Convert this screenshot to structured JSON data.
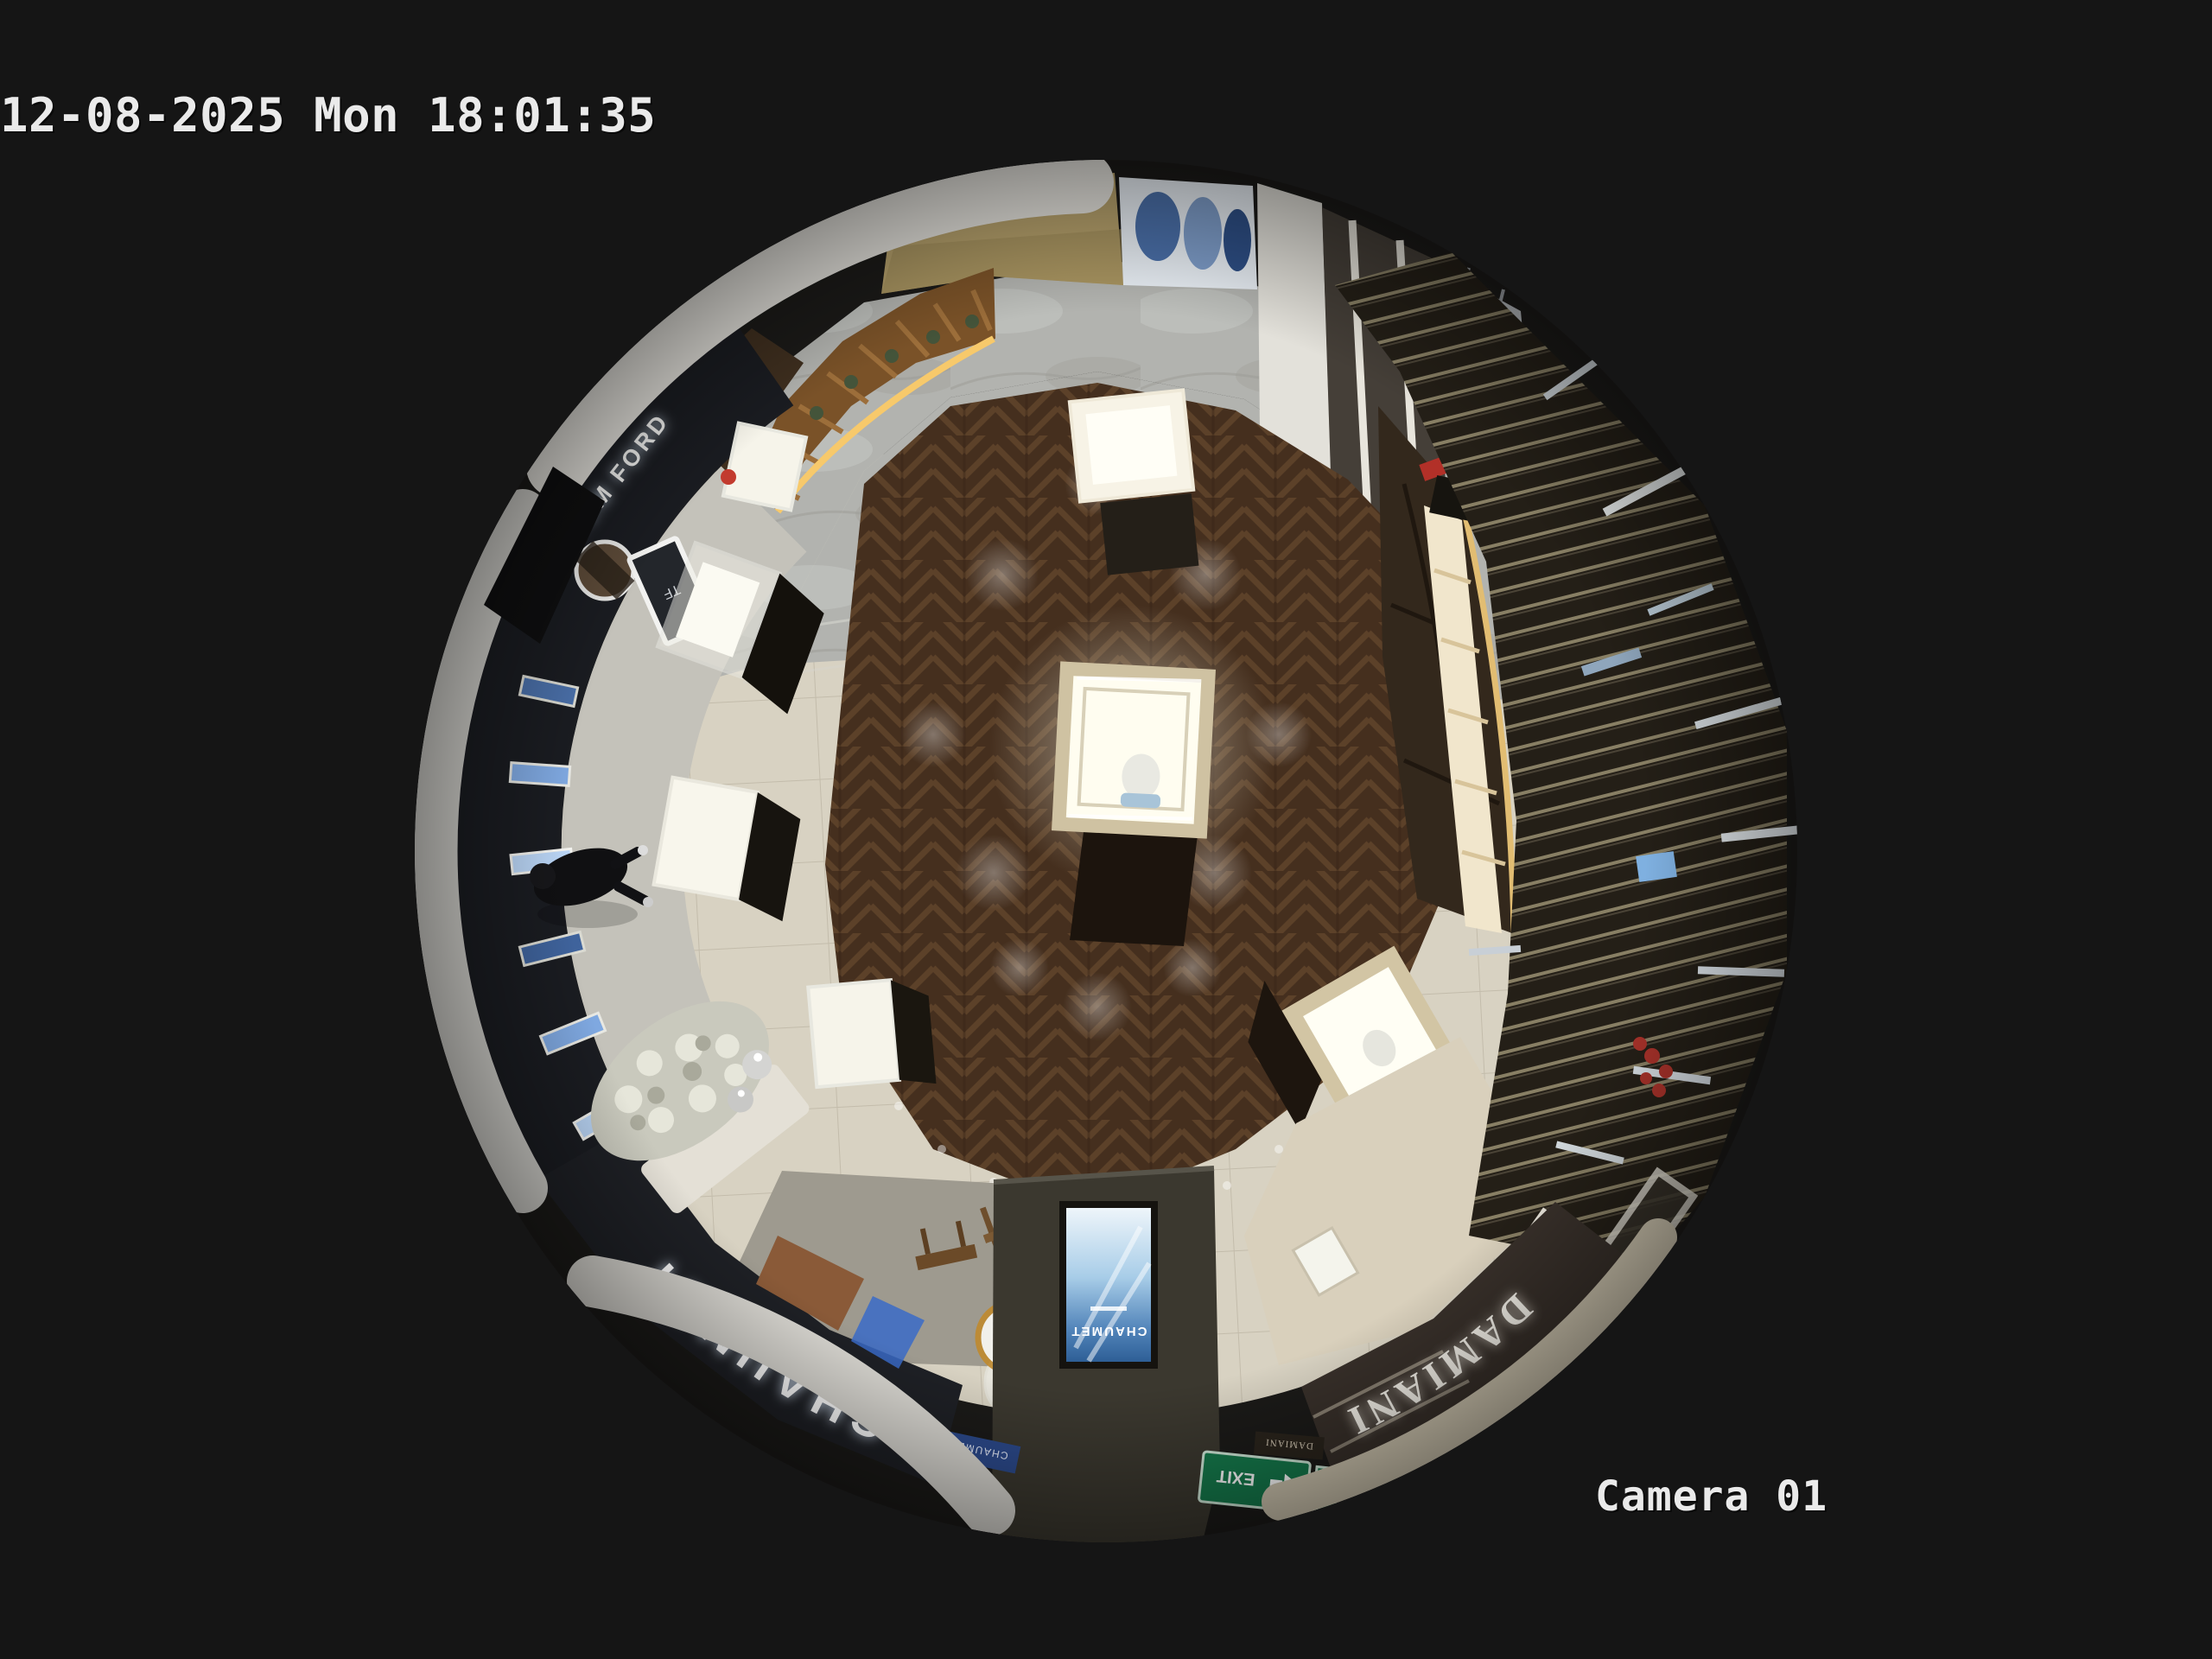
{
  "osd": {
    "timestamp": "12-08-2025 Mon 18:01:35",
    "camera_label": "Camera 01",
    "text_color": "#eaeaea"
  },
  "scene": {
    "signs": {
      "tom_ford": "TOM FORD",
      "tf_monogram": "TF",
      "chaumet_storefront": "CHAUMET",
      "chaumet_screen": "CHAUMET",
      "chaumet_window_panel": "CHAUMET",
      "damiani_storefront": "DAMIANI",
      "damiani_window_panel": "DAMIANI",
      "exit": "EXIT"
    },
    "colors": {
      "background": "#151515",
      "wood_floor": "#452f1e",
      "tile_floor": "#d8d2c2",
      "marble_floor": "#b2b3af",
      "storefront_dark": "#1a1c21",
      "sign_glow": "#ffffff",
      "exit_green": "#157a4c",
      "screen_blue": "#4f82b8",
      "led_warm": "#f7c96b",
      "ceiling_white": "#e4e2dc",
      "kiosk_wood": "#7a5228"
    }
  }
}
